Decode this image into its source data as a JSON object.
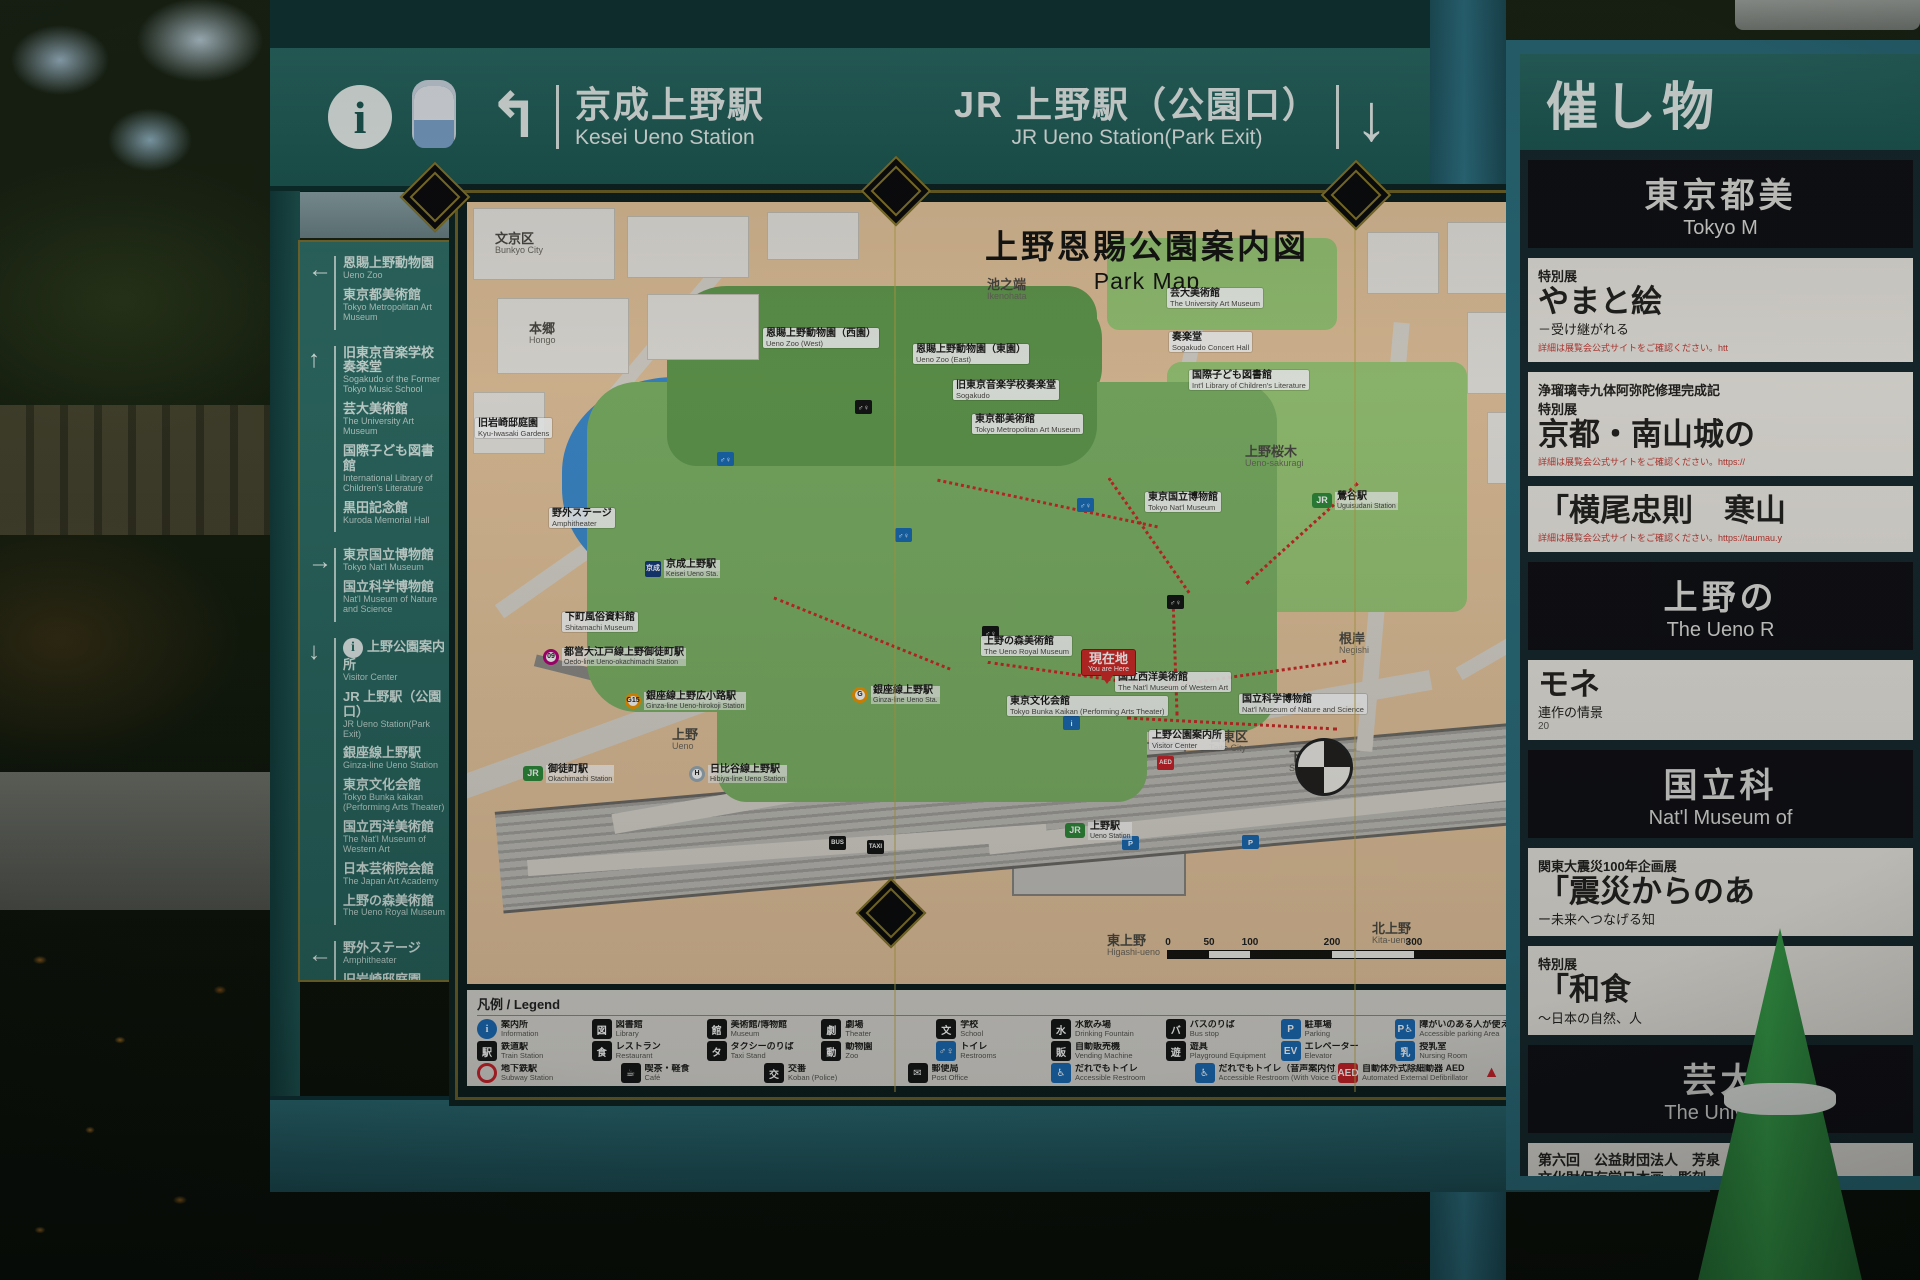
{
  "colors": {
    "sign_teal": "#2a6a64",
    "sign_teal_dark": "#1d5852",
    "post_teal": "#2e7283",
    "gold_frame": "#8a7a2a",
    "map_peach": "#e8c79e",
    "park_green": "#7fb567",
    "zoo_green": "#649e50",
    "museum_green": "#9ccb78",
    "pond_blue": "#3e8ed2",
    "route_red": "#cf2a28",
    "legend_bg": "#dad8d2",
    "poi_blue": "#1a6bb5",
    "poi_black": "#151515"
  },
  "header": {
    "info_icon": "i",
    "left": {
      "arrow": "↰",
      "jp": "京成上野駅",
      "en": "Kesei Ueno Station"
    },
    "right": {
      "jp": "JR 上野駅（公園口）",
      "en": "JR Ueno Station(Park Exit)",
      "arrow": "↓"
    }
  },
  "sidebar": {
    "groups": [
      {
        "arrow": "left",
        "items": [
          {
            "jp": "恩賜上野動物園",
            "en": "Ueno Zoo"
          },
          {
            "jp": "東京都美術館",
            "en": "Tokyo Metropolitan Art Museum"
          }
        ]
      },
      {
        "arrow": "up",
        "items": [
          {
            "jp": "旧東京音楽学校奏楽堂",
            "en": "Sogakudo of the Former Tokyo Music School"
          },
          {
            "jp": "芸大美術館",
            "en": "The University Art Museum"
          },
          {
            "jp": "国際子ども図書館",
            "en": "International Library of Children's Literature"
          },
          {
            "jp": "黒田記念館",
            "en": "Kuroda Memorial Hall"
          }
        ]
      },
      {
        "arrow": "right",
        "items": [
          {
            "jp": "東京国立博物館",
            "en": "Tokyo Nat'l Museum"
          },
          {
            "jp": "国立科学博物館",
            "en": "Nat'l Museum of Nature and Science"
          }
        ]
      },
      {
        "arrow": "down",
        "items": [
          {
            "jp": "上野公園案内所",
            "en": "Visitor Center",
            "icon": "info"
          },
          {
            "jp": "JR 上野駅（公園口）",
            "en": "JR Ueno Station(Park Exit)"
          },
          {
            "jp": "銀座線上野駅",
            "en": "Ginza-line Ueno Station"
          },
          {
            "jp": "東京文化会館",
            "en": "Tokyo Bunka kaikan (Performing Arts Theater)"
          },
          {
            "jp": "国立西洋美術館",
            "en": "The Nat'l Museum of Western Art"
          },
          {
            "jp": "日本芸術院会館",
            "en": "The Japan Art Academy"
          },
          {
            "jp": "上野の森美術館",
            "en": "The Ueno Royal Museum"
          }
        ]
      },
      {
        "arrow": "left",
        "items": [
          {
            "jp": "野外ステージ",
            "en": "Amphitheater"
          },
          {
            "jp": "旧岩崎邸庭園",
            "en": "Kyu-Iwasaki-tei Gardens"
          },
          {
            "jp": "京成上野駅",
            "en": "Keisei Ueno Station"
          }
        ]
      }
    ]
  },
  "map": {
    "title_jp": "上野恩賜公園案内図",
    "title_en": "Park Map",
    "legend_title": "凡例 / Legend",
    "scale": {
      "ticks": [
        "0",
        "50",
        "100",
        "200",
        "300",
        "500m"
      ],
      "segments": [
        41,
        41,
        82,
        82,
        164
      ]
    },
    "labels": [
      {
        "type": "area",
        "jp": "文京区",
        "en": "Bunkyo City",
        "x": 28,
        "y": 30
      },
      {
        "type": "area",
        "jp": "本郷",
        "en": "Hongo",
        "x": 62,
        "y": 120
      },
      {
        "type": "area",
        "jp": "池之端",
        "en": "Ikenohata",
        "x": 520,
        "y": 76
      },
      {
        "type": "area",
        "jp": "谷中",
        "en": "Yanaka",
        "x": 1058,
        "y": 58
      },
      {
        "type": "area",
        "jp": "上野桜木",
        "en": "Ueno-sakuragi",
        "x": 778,
        "y": 243
      },
      {
        "type": "area",
        "jp": "根岸",
        "en": "Negishi",
        "x": 872,
        "y": 430
      },
      {
        "type": "area",
        "jp": "台東区",
        "en": "Taito City",
        "x": 742,
        "y": 528
      },
      {
        "type": "area",
        "jp": "下谷",
        "en": "Shitaya",
        "x": 822,
        "y": 548
      },
      {
        "type": "area",
        "jp": "東上野",
        "en": "Higashi-ueno",
        "x": 640,
        "y": 732
      },
      {
        "type": "area",
        "jp": "北上野",
        "en": "Kita-ueno",
        "x": 905,
        "y": 720
      },
      {
        "type": "area",
        "jp": "上野",
        "en": "Ueno",
        "x": 205,
        "y": 526
      },
      {
        "type": "place",
        "jp": "旧岩崎邸庭園",
        "en": "Kyu-Iwasaki Gardens",
        "x": 8,
        "y": 216
      },
      {
        "type": "place",
        "jp": "恩賜上野動物園（西園）",
        "en": "Ueno Zoo (West)",
        "x": 296,
        "y": 126
      },
      {
        "type": "place",
        "jp": "恩賜上野動物園（東園）",
        "en": "Ueno Zoo (East)",
        "x": 446,
        "y": 142
      },
      {
        "type": "place",
        "jp": "旧東京音楽学校奏楽堂",
        "en": "Sogakudo",
        "x": 486,
        "y": 178
      },
      {
        "type": "place",
        "jp": "東京都美術館",
        "en": "Tokyo Metropolitan Art Museum",
        "x": 505,
        "y": 212
      },
      {
        "type": "place",
        "jp": "芸大美術館",
        "en": "The University Art Museum",
        "x": 700,
        "y": 86
      },
      {
        "type": "place",
        "jp": "奏楽堂",
        "en": "Sogakudo Concert Hall",
        "x": 702,
        "y": 130
      },
      {
        "type": "place",
        "jp": "国際子ども図書館",
        "en": "Int'l Library of Children's Literature",
        "x": 722,
        "y": 168
      },
      {
        "type": "place",
        "jp": "東京国立博物館",
        "en": "Tokyo Nat'l Museum",
        "x": 678,
        "y": 290
      },
      {
        "type": "place",
        "jp": "国立科学博物館",
        "en": "Nat'l Museum of Nature and Science",
        "x": 772,
        "y": 492
      },
      {
        "type": "place",
        "jp": "国立西洋美術館",
        "en": "The Nat'l Museum of Western Art",
        "x": 648,
        "y": 470
      },
      {
        "type": "place",
        "jp": "東京文化会館",
        "en": "Tokyo Bunka Kaikan (Performing Arts Theater)",
        "x": 540,
        "y": 494
      },
      {
        "type": "place",
        "jp": "上野公園案内所",
        "en": "Visitor Center",
        "x": 682,
        "y": 528
      },
      {
        "type": "you",
        "jp": "現在地",
        "en": "You are Here",
        "x": 615,
        "y": 448
      },
      {
        "type": "place",
        "jp": "上野の森美術館",
        "en": "The Ueno Royal Museum",
        "x": 514,
        "y": 434
      },
      {
        "type": "place",
        "jp": "下町風俗資料館",
        "en": "Shitamachi Museum",
        "x": 95,
        "y": 410
      },
      {
        "type": "place",
        "jp": "野外ステージ",
        "en": "Amphitheater",
        "x": 82,
        "y": 306
      },
      {
        "type": "station-keisei",
        "badge": "京成",
        "jp": "京成上野駅",
        "en": "Keisei Ueno Sta.",
        "x": 178,
        "y": 358
      },
      {
        "type": "station-jr",
        "badge": "JR",
        "jp": "上野駅",
        "en": "Ueno Station",
        "x": 598,
        "y": 620
      },
      {
        "type": "station-metro",
        "badge": "G",
        "color": "#f39700",
        "jp": "銀座線上野駅",
        "en": "Ginza-line Ueno Sta.",
        "x": 385,
        "y": 484
      },
      {
        "type": "station-metro",
        "badge": "09",
        "color": "#b6007a",
        "jp": "都営大江戸線上野御徒町駅",
        "en": "Oedo-line Ueno-okachimachi Station",
        "x": 76,
        "y": 446
      },
      {
        "type": "station-metro",
        "badge": "G15",
        "color": "#f39700",
        "jp": "銀座線上野広小路駅",
        "en": "Ginza-line Ueno-hirokoji Station",
        "x": 158,
        "y": 490
      },
      {
        "type": "station-jr",
        "badge": "JR",
        "jp": "御徒町駅",
        "en": "Okachimachi Station",
        "x": 56,
        "y": 563
      },
      {
        "type": "station-metro",
        "badge": "H",
        "color": "#9caeb7",
        "jp": "日比谷線上野駅",
        "en": "Hibiya-line Ueno Station",
        "x": 222,
        "y": 563
      },
      {
        "type": "station-jr",
        "badge": "JR",
        "jp": "鶯谷駅",
        "en": "Uguisudani Station",
        "x": 845,
        "y": 290
      }
    ],
    "pois": [
      {
        "t": "wc",
        "x": 428,
        "y": 326
      },
      {
        "t": "wc",
        "x": 610,
        "y": 296
      },
      {
        "t": "wcb",
        "x": 388,
        "y": 198
      },
      {
        "t": "wcb",
        "x": 515,
        "y": 424
      },
      {
        "t": "p",
        "x": 655,
        "y": 634
      },
      {
        "t": "p",
        "x": 775,
        "y": 633
      },
      {
        "t": "bus",
        "x": 362,
        "y": 634
      },
      {
        "t": "info",
        "x": 596,
        "y": 514
      },
      {
        "t": "aed",
        "x": 690,
        "y": 554
      },
      {
        "t": "wc",
        "x": 250,
        "y": 250
      },
      {
        "t": "wcb",
        "x": 700,
        "y": 393
      },
      {
        "t": "taxi",
        "x": 400,
        "y": 638
      }
    ],
    "legend_rows": [
      [
        {
          "jp": "案内所",
          "en": "Information",
          "icon": {
            "t": "circle",
            "bg": "#1a6bb5",
            "glyph": "i"
          }
        },
        {
          "jp": "図書館",
          "en": "Library",
          "icon": {
            "t": "sq",
            "bg": "#151515",
            "glyph": "図"
          }
        },
        {
          "jp": "美術館/博物館",
          "en": "Museum",
          "icon": {
            "t": "sq",
            "bg": "#151515",
            "glyph": "館"
          }
        },
        {
          "jp": "劇場",
          "en": "Theater",
          "icon": {
            "t": "sq",
            "bg": "#151515",
            "glyph": "劇"
          }
        },
        {
          "jp": "学校",
          "en": "School",
          "icon": {
            "t": "sq",
            "bg": "#151515",
            "glyph": "文"
          }
        },
        {
          "jp": "水飲み場",
          "en": "Drinking Fountain",
          "icon": {
            "t": "sq",
            "bg": "#151515",
            "glyph": "水"
          }
        },
        {
          "jp": "バスのりば",
          "en": "Bus stop",
          "icon": {
            "t": "sq",
            "bg": "#151515",
            "glyph": "バ"
          }
        },
        {
          "jp": "駐車場",
          "en": "Parking",
          "icon": {
            "t": "sq",
            "bg": "#1a6bb5",
            "glyph": "P"
          }
        },
        {
          "jp": "障がいのある人が使える駐車場",
          "en": "Accessible parking Area",
          "icon": {
            "t": "sq",
            "bg": "#1a6bb5",
            "glyph": "P♿"
          }
        },
        {
          "jp": "上野公園バス専用駐車場",
          "en": "Ueno Bus Parking",
          "icon": {
            "t": "sq",
            "bg": "#1a6bb5",
            "glyph": "P"
          }
        }
      ],
      [
        {
          "jp": "鉄道駅",
          "en": "Train Station",
          "icon": {
            "t": "sq",
            "bg": "#151515",
            "glyph": "駅"
          }
        },
        {
          "jp": "レストラン",
          "en": "Restaurant",
          "icon": {
            "t": "sq",
            "bg": "#151515",
            "glyph": "食"
          }
        },
        {
          "jp": "タクシーのりば",
          "en": "Taxi Stand",
          "icon": {
            "t": "sq",
            "bg": "#151515",
            "glyph": "タ"
          }
        },
        {
          "jp": "動物園",
          "en": "Zoo",
          "icon": {
            "t": "sq",
            "bg": "#151515",
            "glyph": "動"
          }
        },
        {
          "jp": "トイレ",
          "en": "Restrooms",
          "icon": {
            "t": "sq",
            "bg": "#1a6bb5",
            "glyph": "♂♀"
          }
        },
        {
          "jp": "自動販売機",
          "en": "Vending Machine",
          "icon": {
            "t": "sq",
            "bg": "#151515",
            "glyph": "販"
          }
        },
        {
          "jp": "遊具",
          "en": "Playground Equipment",
          "icon": {
            "t": "sq",
            "bg": "#151515",
            "glyph": "遊"
          }
        },
        {
          "jp": "エレベーター",
          "en": "Elevator",
          "icon": {
            "t": "sq",
            "bg": "#1a6bb5",
            "glyph": "EV"
          }
        },
        {
          "jp": "授乳室",
          "en": "Nursing Room",
          "icon": {
            "t": "sq",
            "bg": "#1a6bb5",
            "glyph": "乳"
          }
        },
        {
          "jp": "バリアフリー経路",
          "en": "Barrier-Free Route",
          "icon": {
            "t": "dots",
            "bg": "#cc2229",
            "glyph": "•••••"
          }
        }
      ],
      [
        {
          "jp": "地下鉄駅",
          "en": "Subway Station",
          "icon": {
            "t": "ring",
            "bg": "#cc2229",
            "glyph": ""
          }
        },
        {
          "jp": "喫茶・軽食",
          "en": "Café",
          "icon": {
            "t": "sq",
            "bg": "#151515",
            "glyph": "☕"
          }
        },
        {
          "jp": "交番",
          "en": "Koban (Police)",
          "icon": {
            "t": "sq",
            "bg": "#151515",
            "glyph": "交"
          }
        },
        {
          "jp": "郵便局",
          "en": "Post Office",
          "icon": {
            "t": "sq",
            "bg": "#151515",
            "glyph": "✉"
          }
        },
        {
          "jp": "だれでもトイレ",
          "en": "Accessible Restroom",
          "icon": {
            "t": "sq",
            "bg": "#1a6bb5",
            "glyph": "♿"
          }
        },
        {
          "jp": "だれでもトイレ（音声案内付）",
          "en": "Accessible Restroom (With Voice Guidance)",
          "icon": {
            "t": "sq",
            "bg": "#1a6bb5",
            "glyph": "♿"
          }
        },
        {
          "jp": "自動体外式除細動器 AED",
          "en": "Automated External Defibrillator",
          "icon": {
            "t": "sq",
            "bg": "#cc2229",
            "glyph": "AED"
          }
        },
        {
          "jp": "施設入口",
          "en": "Entrance",
          "icon": {
            "t": "tri",
            "bg": "#cc2229",
            "glyph": "▲"
          }
        }
      ]
    ]
  },
  "side_panel": {
    "title_jp": "催し物",
    "posters": [
      {
        "type": "dark",
        "jp": "東京都美",
        "en": "Tokyo M"
      },
      {
        "type": "light",
        "tag": "特別展",
        "title": "やまと絵",
        "sub": "－受け継がれる",
        "note": "詳細は展覧会公式サイトをご確認ください。htt"
      },
      {
        "type": "light",
        "tag": "浄瑠璃寺九体阿弥陀修理完成記",
        "tag2": "特別展",
        "title": "京都・南山城の",
        "note": "詳細は展覧会公式サイトをご確認ください。https://"
      },
      {
        "type": "light",
        "title": "「横尾忠則　寒山",
        "note": "詳細は展覧会公式サイトをご確認ください。https://taumau.y"
      },
      {
        "type": "dark",
        "jp": "上野の",
        "en": "The Ueno R"
      },
      {
        "type": "light",
        "title": "モネ",
        "sub": "連作の情景",
        "side": "20"
      },
      {
        "type": "dark",
        "jp": "国立科",
        "en": "Nat'l Museum of"
      },
      {
        "type": "light",
        "tag": "関東大震災100年企画展",
        "title": "「震災からのあ",
        "sub": "ー未来へつなげる知"
      },
      {
        "type": "light",
        "tag": "特別展",
        "title": "「和食",
        "sub": "～日本の自然、人"
      },
      {
        "type": "dark",
        "jp": "芸大",
        "en": "The Universi"
      },
      {
        "type": "light",
        "lines": [
          "第六回　公益財団法人　芳泉",
          "文化財保存学日本画・彫刻",
          "「美しさの新機軸　～日本"
        ]
      },
      {
        "type": "teal",
        "lines": [
          "芸術は未来に",
          "芸術未"
        ],
        "en": "GEIJYUTSU MIRAI KENKYU"
      }
    ]
  }
}
